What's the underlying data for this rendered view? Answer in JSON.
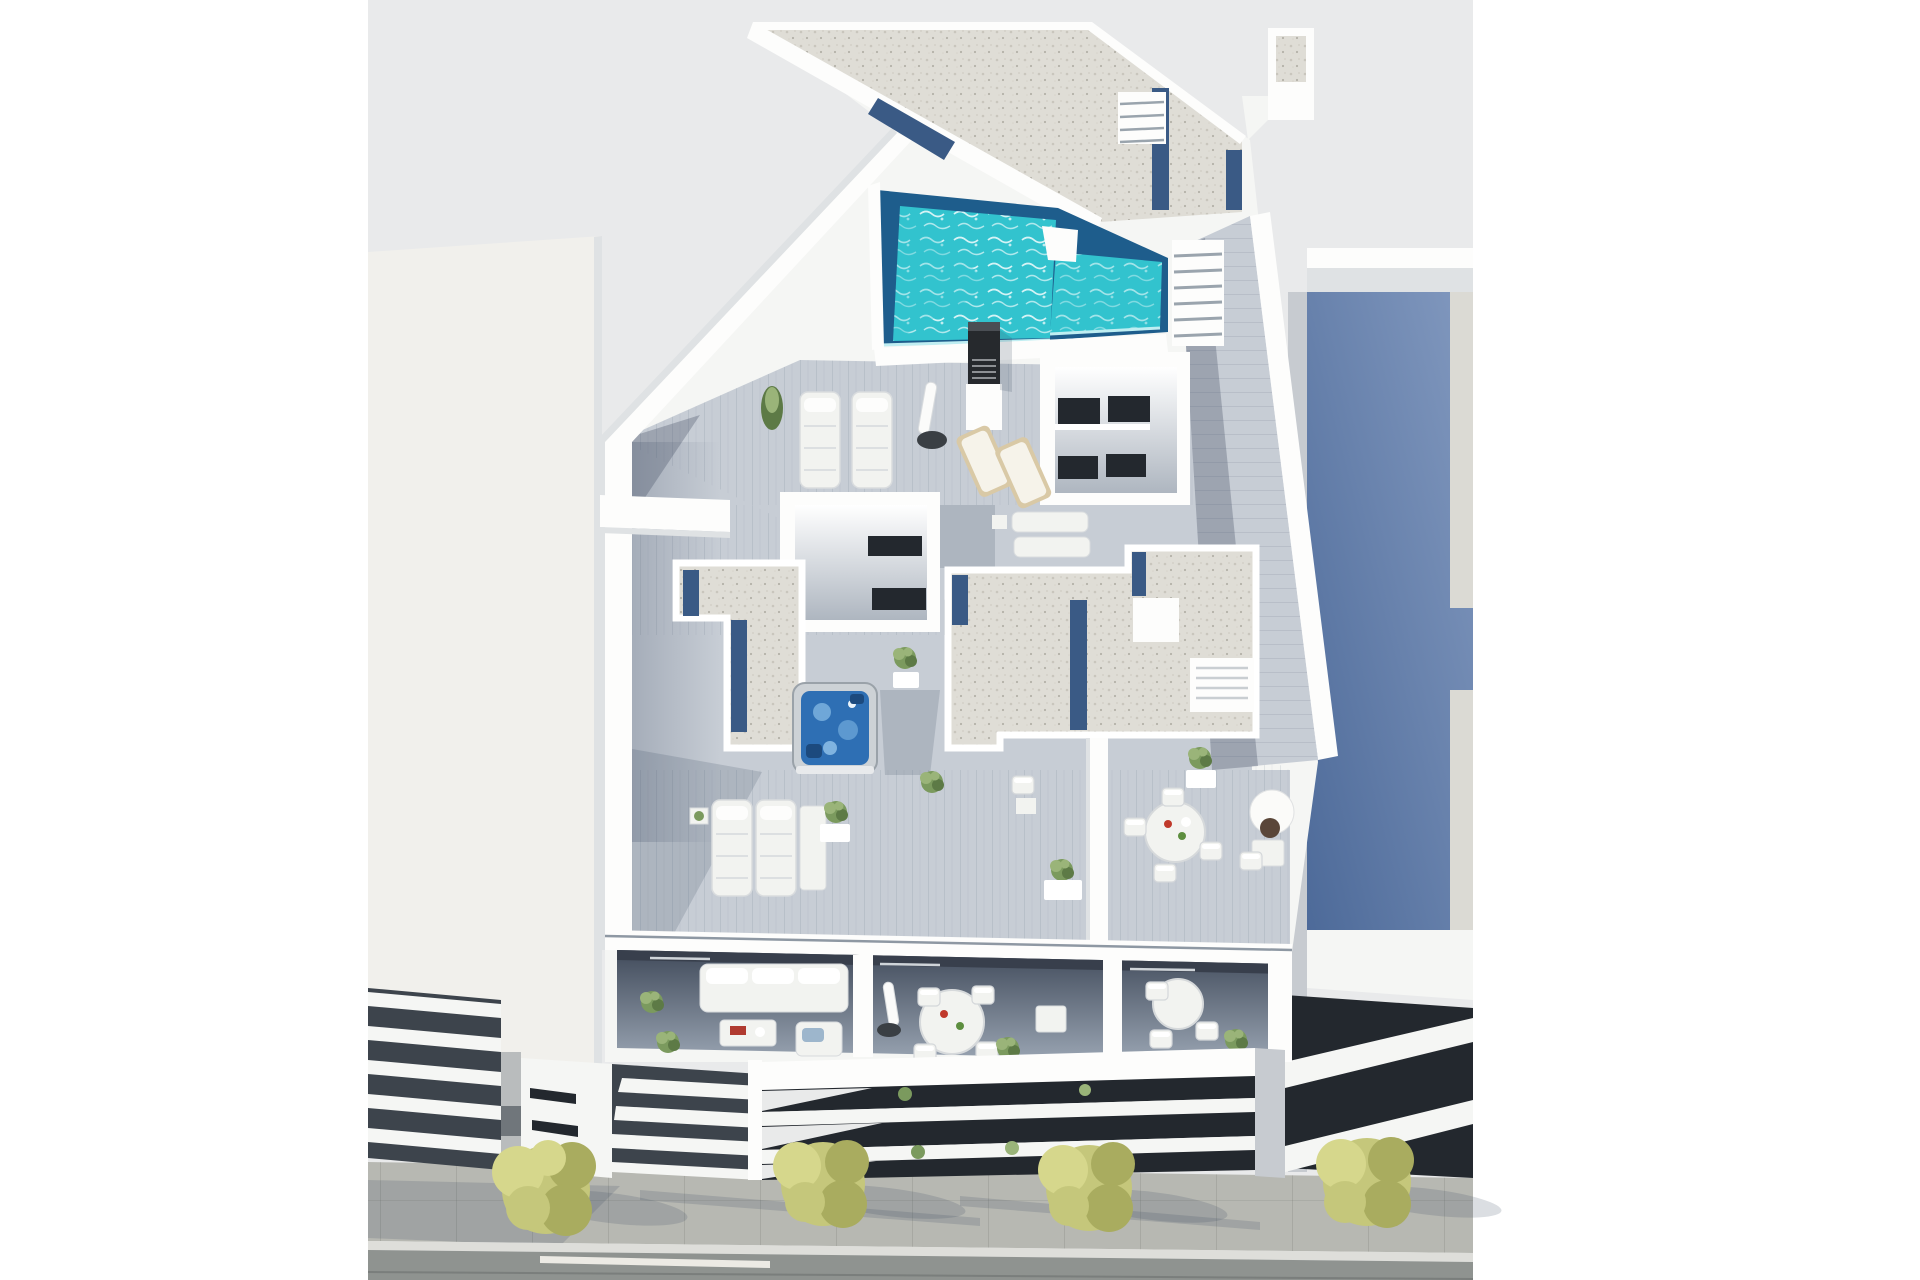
{
  "meta": {
    "kind": "3d-architectural-render",
    "view": "aerial-oblique",
    "width_px": 1920,
    "height_px": 1280,
    "text_content": "none"
  },
  "scene": {
    "description": "Aerial 3D render of a modern white apartment block with an L-shaped turquoise rooftop pool, gravel flat roof, wood-plank roof terraces with sun loungers, a hot tub, two stairwell bulkheads, three furnished balconies over a glass-band street facade, flanked by a plain white neighbour on the left and a blue-roofed neighbour on the right, with a paved sidewalk, four yellow-green trees and an asphalt road in front.",
    "colors": {
      "margin": "#ffffff",
      "backdrop": "#e9eaeb",
      "wall_white": "#f5f6f4",
      "wall_bright": "#fdfdfc",
      "wall_shade": "#dfe2e4",
      "wall_dark": "#c7cbd0",
      "left_building": "#f1f0ec",
      "gravel": "#dfddd6",
      "navy_strip": "#3a5a85",
      "pool_deep": "#1e5d8c",
      "pool_water": "#32c3ce",
      "pool_light": "#9fe8ec",
      "deck": "#c7cdd5",
      "deck_shade": "#76849a",
      "glass_dark": "#23282e",
      "louver_dark": "#3d444c",
      "blue_roof": "#5b76a4",
      "blue_roof_light": "#8096bd",
      "roof_border": "#dbdad4",
      "jacuzzi_water": "#2e6fb4",
      "sidewalk": "#b7b8b2",
      "paver_line": "#a2a39c",
      "curb": "#dededa",
      "road": "#8f9390",
      "lane": "#eceae4",
      "furniture_white": "#f2f3f0",
      "wood": "#d9c9a6",
      "plant_dark": "#5d7a46",
      "plant_mid": "#7b9a5e",
      "plant_light": "#9ab479",
      "tree": "#c5c77b",
      "tree_dark": "#a9ac5f",
      "tree_light": "#d6d78c"
    },
    "buildings": {
      "main": {
        "features": [
          "gravel flat roof with navy drainage strips",
          "L-shaped turquoise pool with dark deep end",
          "black chimney vent",
          "pool terrace with cypress, padded loungers, closed parasol, two wooden loungers",
          "two white stairwell bulkheads with dark slit windows",
          "large gravel plant-room roof with louvered closet",
          "hot tub with blue water",
          "wood-plank terraces with lounger pairs, dining sets, open parasol, potted plants",
          "three lower balconies: sofa set, round dining table, square table",
          "street facade of white slabs over dark glass bands with planting"
        ]
      },
      "left_neighbor": {
        "features": [
          "plain flat white wall plane",
          "street facade of stacked white louver slabs",
          "grey pillar",
          "white wall with three wedge windows"
        ]
      },
      "right_neighbor": {
        "features": [
          "blue-grey flat roof with cross-shaped extension and pale borders",
          "white parapet",
          "dark glass facade crossed by rising white balcony slabs"
        ]
      }
    },
    "street": {
      "trees": 4,
      "elements": [
        "large-paver sidewalk",
        "long tree and facade shadows",
        "light curb strip",
        "asphalt road",
        "white lane marking"
      ]
    },
    "furniture_counts": {
      "sun_lounger_pairs": 4,
      "dining_sets": 4,
      "sofa_sets": 1,
      "hot_tubs": 1,
      "parasols": 3,
      "potted_plants": 16
    }
  }
}
